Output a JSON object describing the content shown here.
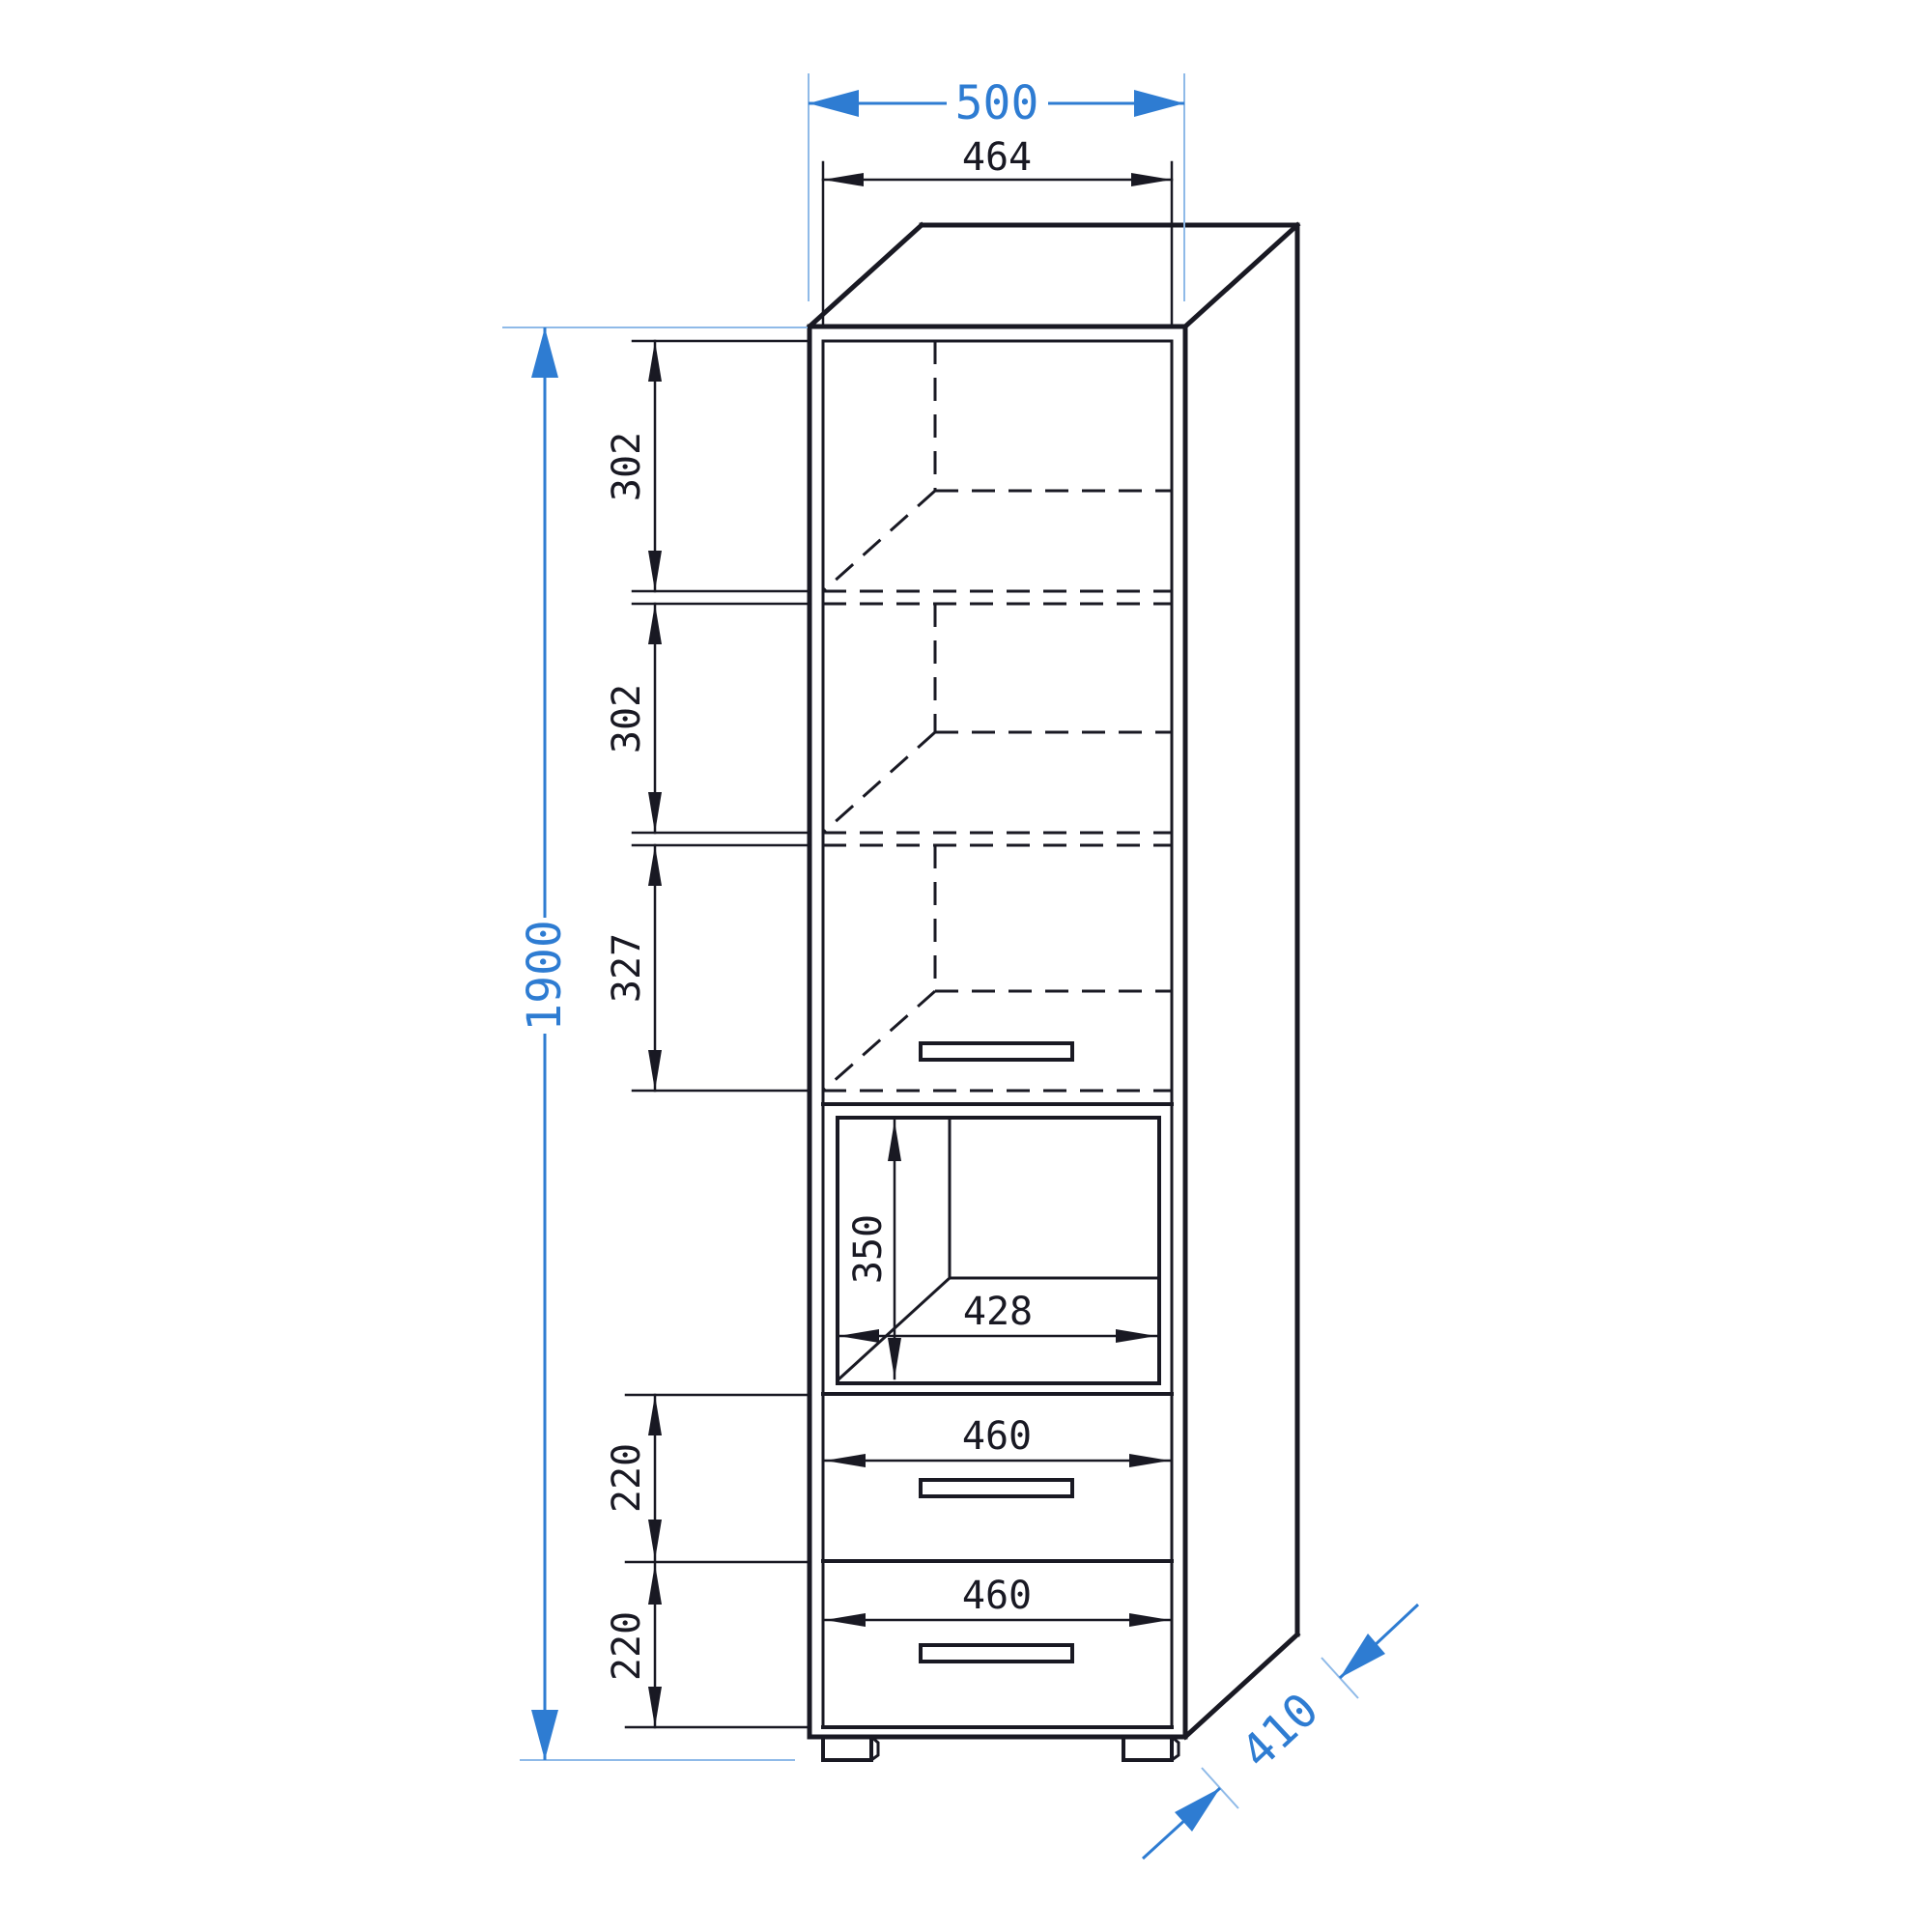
{
  "drawing": {
    "type": "furniture-dimension-drawing",
    "object": "tall cabinet with door, shelves, open niche and two drawers",
    "units": "mm",
    "colors": {
      "line_black": "#191923",
      "dimension_blue": "#2e7cd2",
      "extension_light_blue": "#8fbae8",
      "background": "#ffffff"
    },
    "labels": {
      "outer_width": "500",
      "inner_width": "464",
      "total_height": "1900",
      "depth": "410",
      "compartment_1_height": "302",
      "compartment_2_height": "302",
      "compartment_3_height": "327",
      "niche_height": "350",
      "niche_width": "428",
      "drawer_1_width": "460",
      "drawer_1_height": "220",
      "drawer_2_width": "460",
      "drawer_2_height": "220"
    }
  }
}
